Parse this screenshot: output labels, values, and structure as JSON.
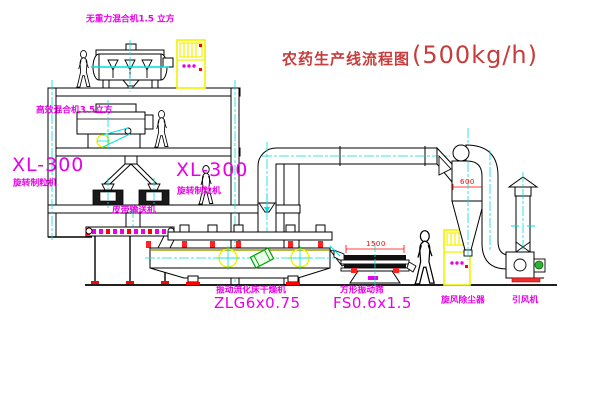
{
  "title": {
    "name_cn": "农药生产线流程图",
    "capacity": "(500kg/h)"
  },
  "labels": {
    "gravity_mixer": "无重力混合机1.5 立方",
    "high_eff_mixer": "高效混合机3.5立方",
    "granulator_left_model": "XL-300",
    "granulator_left_name": "旋转制粒机",
    "granulator_right_model": "XL-300",
    "granulator_right_name": "旋转制粒机",
    "belt_conveyor": "皮带输送机",
    "dryer_name": "振动流化床干燥机",
    "dryer_model": "ZLG6x0.75",
    "screen_name": "方形振动筛",
    "screen_model": "FS0.6x1.5",
    "cyclone": "旋风除尘器",
    "fan": "引风机"
  },
  "dimensions": {
    "screen_length": "1500",
    "cyclone_diameter": "600"
  },
  "colors": {
    "label_magenta": "#e800e8",
    "title_red": "#c83c3c",
    "dimension_red": "#ff0000",
    "centerline_cyan": "#00dede",
    "cabinet_yellow": "#f2f200",
    "motor_green": "#00a000"
  }
}
